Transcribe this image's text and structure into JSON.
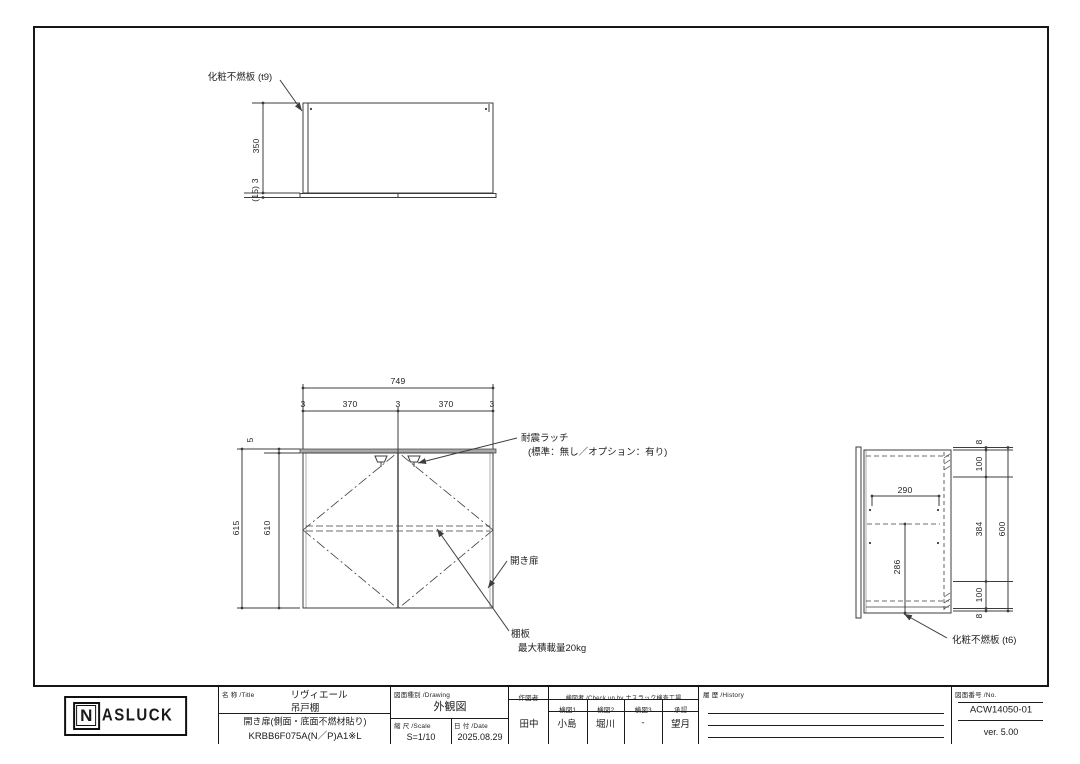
{
  "colors": {
    "line": "#3c3c3c",
    "text": "#1a1a1a",
    "panel_gray": "#a8a8a8"
  },
  "views": {
    "top": {
      "panel_label": "化粧不燃板 (t9)",
      "dim_depth": "350",
      "dim_bottom": "(15) 3"
    },
    "front": {
      "dim_width_total": "749",
      "dim_widths": [
        "3",
        "370",
        "3",
        "370",
        "3"
      ],
      "dim_height_outer": "615",
      "dim_height_inner": "610",
      "dim_top_gap": "5",
      "latch_label": "耐震ラッチ",
      "latch_note": "(標準：無し／オプション：有り)",
      "door_label": "開き扉",
      "shelf_label": "棚板",
      "shelf_note": "最大積載量20kg"
    },
    "side": {
      "dim_shelf_depth": "290",
      "dim_shelf_height": "286",
      "dim_right": [
        "8",
        "100",
        "384",
        "100",
        "8"
      ],
      "dim_height_total": "600",
      "panel_label": "化粧不燃板 (t6)"
    }
  },
  "title_block": {
    "logo": {
      "n": "N",
      "rest": "ASLUCK"
    },
    "name": {
      "header": "名 称 /Title",
      "line1": "リヴィエール",
      "line2": "吊戸棚",
      "line3": "開き扉(側面・底面不燃材貼り)",
      "line4": "KRBB6F075A(N／P)A1※L"
    },
    "drawing": {
      "header": "図面種別 /Drawing",
      "value": "外観図"
    },
    "scale": {
      "header": "縮 尺 /Scale",
      "value": "S=1/10"
    },
    "date": {
      "header": "日 付 /Date",
      "value": "2025.08.29"
    },
    "drafter": {
      "header": "作図者",
      "value": "田中"
    },
    "check": {
      "header": "検図者 /Check up by ナスラック検査工場",
      "columns": [
        "検図1",
        "検図2",
        "検図3",
        "承認"
      ],
      "values": [
        "小島",
        "堀川",
        "-",
        "望月"
      ]
    },
    "history": {
      "header": "履 歴 /History"
    },
    "number": {
      "header": "図面番号 /No.",
      "value": "ACW14050-01",
      "version": "ver. 5.00"
    }
  }
}
